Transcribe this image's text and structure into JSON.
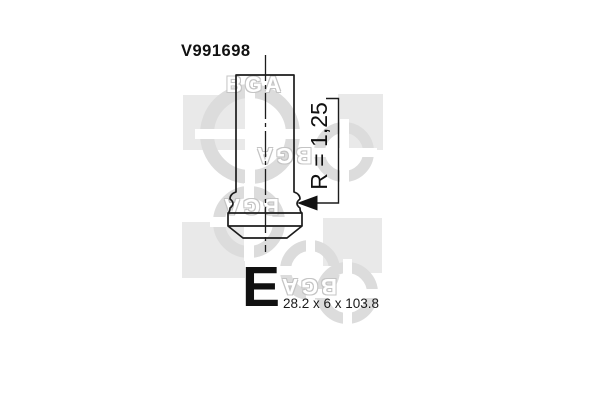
{
  "diagram": {
    "part_number": "V991698",
    "radius_label": "R = 1,25",
    "valve_letter": "E",
    "dimensions": "28.2 x 6 x 103.8"
  },
  "watermark": {
    "brand": "BGA"
  },
  "colors": {
    "background": "#ffffff",
    "line": "#1c1c1c",
    "text": "#111111",
    "watermark_square": "#e9e9e9",
    "watermark_ring": "#dcdcdc"
  }
}
